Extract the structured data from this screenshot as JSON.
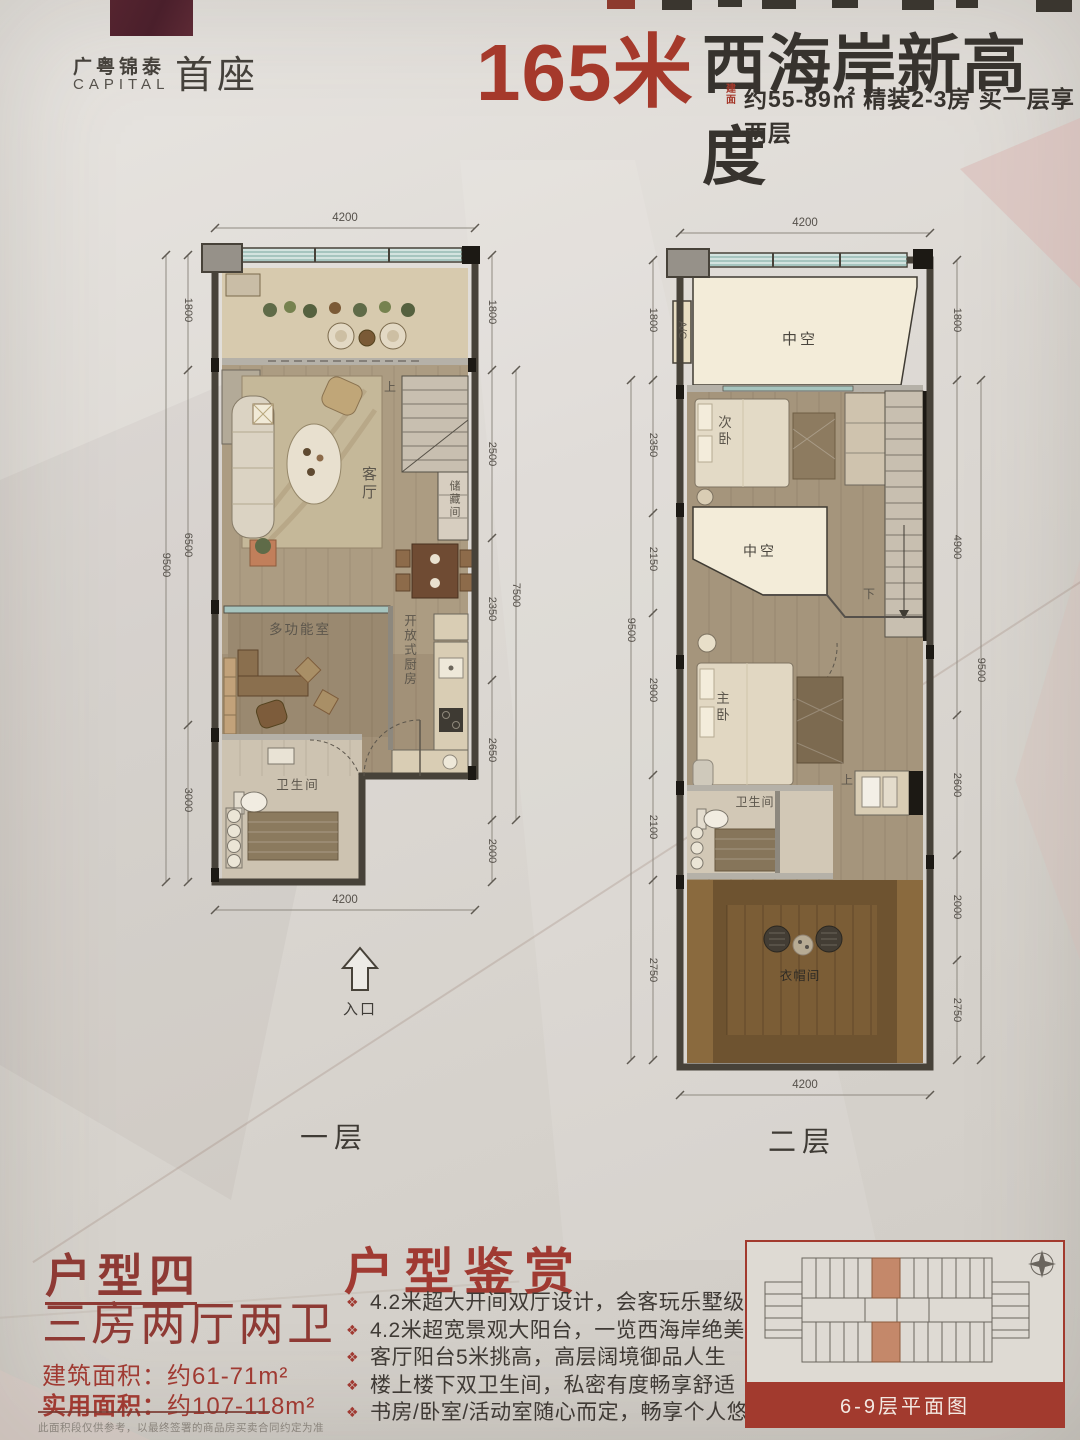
{
  "header": {
    "brand_cn": "广粤锦泰",
    "brand_en": "CAPITAL",
    "brand_name": "首座",
    "headline_number": "165米",
    "headline_text": "西海岸新高度",
    "sub_prefix_1": "建",
    "sub_prefix_2": "面",
    "subtitle": "约55-89㎡ 精装2-3房 买一层享两层"
  },
  "colors": {
    "accent_red": "#a5392b",
    "logo_maroon": "#4e2230",
    "band_red": "#a23a2e"
  },
  "floor1": {
    "label": "一层",
    "entrance_label": "入口",
    "rooms": {
      "living": "客厅",
      "storage": "储藏间",
      "multi": "多功能室",
      "kitchen": "开放式厨房",
      "bath": "卫生间",
      "up": "上"
    },
    "dims": {
      "top": "4200",
      "bottom": "4200",
      "left": [
        "1800",
        "6500",
        "3000"
      ],
      "left_total": "9500",
      "right": [
        "1800",
        "2500",
        "2350",
        "2650",
        "2000"
      ],
      "right_total": "7500"
    }
  },
  "floor2": {
    "label": "二层",
    "rooms": {
      "void1": "中空",
      "bed2": "次卧",
      "void2": "中空",
      "master": "主卧",
      "bath": "卫生间",
      "closet": "衣帽间",
      "ac": "A/C",
      "down": "下",
      "up": "上"
    },
    "dims": {
      "top": "4200",
      "bottom": "4200",
      "left": [
        "1800",
        "2350",
        "2150",
        "2900",
        "2100",
        "2750"
      ],
      "left_total": "9500",
      "right": [
        "1800",
        "4900",
        "2600",
        "2000",
        "2750"
      ],
      "right_total": "9500"
    }
  },
  "info": {
    "unit_title": "户型四",
    "unit_layout": "三房两厅两卫",
    "area_build_label": "建筑面积：",
    "area_build_value": "约61-71m²",
    "area_usable_label": "实用面积：",
    "area_usable_value": "约107-118m²",
    "disclaimer": "此面积段仅供参考，以最终签署的商品房买卖合同约定为准"
  },
  "features": {
    "title": "户型鉴赏",
    "items": [
      "4.2米超大开间双厅设计，会客玩乐墅级尊贵",
      "4.2米超宽景观大阳台，一览西海岸绝美大境",
      "客厅阳台5米挑高，高层阔境御品人生",
      "楼上楼下双卫生间，私密有度畅享舒适",
      "书房/卧室/活动室随心而定，畅享个人悠然片刻"
    ]
  },
  "miniplan": {
    "caption": "6-9层平面图"
  }
}
